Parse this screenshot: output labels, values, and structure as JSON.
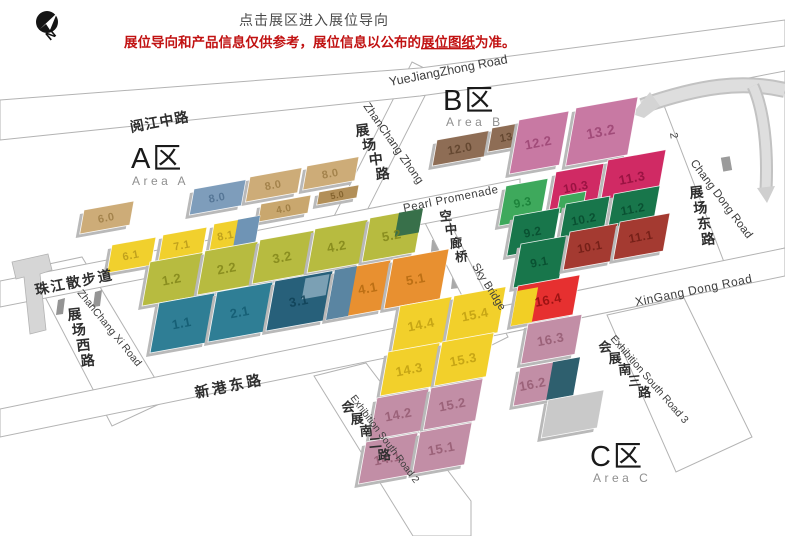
{
  "notice": {
    "click_hint": "点击展区进入展位导向",
    "disclaimer_prefix": "展位导向和产品信息仅供参考，展位信息以公布的",
    "disclaimer_link": "展位图纸",
    "disclaimer_suffix": "为准。",
    "accent_color": "#c11212"
  },
  "compass": {
    "label": "N"
  },
  "areas": [
    {
      "title": "A区",
      "subtitle": "Area A"
    },
    {
      "title": "B区",
      "subtitle": "Area B"
    },
    {
      "title": "C区",
      "subtitle": "Area C"
    }
  ],
  "roads": {
    "yuejiang_cn": "阅江中路",
    "yuejiang_en": "YueJiangZhong Road",
    "zhanchang_zhong_cn": "展场中路",
    "zhanchang_zhong_en": "ZhanChang Zhong",
    "pearl_promenade": "Pearl Promenade",
    "sky_bridge_cn": "空中廊桥",
    "sky_bridge_en": "Sky Bridge",
    "zhanchang_dong_cn": "展场东路",
    "chang_dong_en": "Chang Dong Road",
    "xingang_cn": "新港东路",
    "xingang_en": "XinGang Dong Road",
    "zhujiang_walk_cn": "珠江散步道",
    "zhanchang_xi_cn": "展场西路",
    "zhanchang_xi_en": "ZhanChang Xi Road",
    "south2_cn": "会展南二路",
    "south2_en": "Exhibition South Road 2",
    "south3_cn": "会展南三路",
    "south3_en": "Exhibition South Road 3",
    "stray_marker": "2"
  },
  "halls": [
    {
      "label": "6.0",
      "x": 84,
      "y": 210,
      "w": 50,
      "h": 24,
      "c": "#cdac78",
      "t": "#9a7a42",
      "fs": 11
    },
    {
      "label": "8.0",
      "x": 194,
      "y": 189,
      "w": 52,
      "h": 26,
      "c": "#7e9dbb",
      "t": "#4c6d8e",
      "fs": 11
    },
    {
      "label": "8.0",
      "x": 250,
      "y": 177,
      "w": 52,
      "h": 25,
      "c": "#cdac78",
      "t": "#9a7a42",
      "fs": 11
    },
    {
      "label": "8.0",
      "x": 307,
      "y": 166,
      "w": 52,
      "h": 24,
      "c": "#cdac78",
      "t": "#9a7a42",
      "fs": 11
    },
    {
      "label": "4.0",
      "x": 261,
      "y": 204,
      "w": 50,
      "h": 18,
      "c": "#c9a76e",
      "t": "#97763c",
      "fs": 10
    },
    {
      "label": "5.0",
      "x": 319,
      "y": 192,
      "w": 40,
      "h": 13,
      "c": "#b28f58",
      "t": "#7a5a26",
      "fs": 9
    },
    {
      "label": "",
      "x": 204,
      "y": 286,
      "w": 46,
      "h": 7,
      "c": "#c9a76e",
      "flat": true
    },
    {
      "label": "6.1",
      "x": 112,
      "y": 245,
      "w": 44,
      "h": 28,
      "c": "#f1d02d",
      "t": "#b5961a",
      "fs": 11
    },
    {
      "label": "7.1",
      "x": 163,
      "y": 235,
      "w": 44,
      "h": 28,
      "c": "#f1d02d",
      "t": "#b5961a",
      "fs": 11
    },
    {
      "label": "8.1",
      "x": 214,
      "y": 224,
      "w": 46,
      "h": 28,
      "c": "#f1d02d",
      "t": "#b5961a",
      "fs": 11,
      "lx": 0.32,
      "parts": [
        {
          "x": 24,
          "y": 0,
          "w": 22,
          "h": 28,
          "c": "#6f94b5"
        }
      ]
    },
    {
      "label": "1.2",
      "x": 150,
      "y": 262,
      "w": 53,
      "h": 44,
      "c": "#b7bb40",
      "t": "#7f8318",
      "fs": 13
    },
    {
      "label": "2.2",
      "x": 205,
      "y": 251,
      "w": 53,
      "h": 44,
      "c": "#b7bb40",
      "t": "#7f8318",
      "fs": 13
    },
    {
      "label": "3.2",
      "x": 260,
      "y": 240,
      "w": 54,
      "h": 44,
      "c": "#b7bb40",
      "t": "#7f8318",
      "fs": 13
    },
    {
      "label": "4.2",
      "x": 315,
      "y": 229,
      "w": 53,
      "h": 44,
      "c": "#b7bb40",
      "t": "#7f8318",
      "fs": 13
    },
    {
      "label": "5.2",
      "x": 370,
      "y": 218,
      "w": 53,
      "h": 44,
      "c": "#b7bb40",
      "t": "#7f8318",
      "fs": 13,
      "parts": [
        {
          "x": 29,
          "y": 0,
          "w": 24,
          "h": 24,
          "c": "#38704a"
        }
      ]
    },
    {
      "label": "1.1",
      "x": 159,
      "y": 303,
      "w": 56,
      "h": 50,
      "c": "#2f7e95",
      "t": "#11596f",
      "fs": 13
    },
    {
      "label": "2.1",
      "x": 217,
      "y": 292,
      "w": 56,
      "h": 50,
      "c": "#2f7e95",
      "t": "#11596f",
      "fs": 13
    },
    {
      "label": "3.1",
      "x": 275,
      "y": 281,
      "w": 58,
      "h": 50,
      "c": "#27607a",
      "t": "#0d3f54",
      "fs": 13,
      "parts": [
        {
          "x": 31,
          "y": 3,
          "w": 24,
          "h": 21,
          "c": "#7ba0b4"
        }
      ]
    },
    {
      "label": "4.1",
      "x": 335,
      "y": 270,
      "w": 56,
      "h": 50,
      "c": "#e89030",
      "t": "#b2680e",
      "fs": 13,
      "lx": 0.68,
      "parts": [
        {
          "x": 0,
          "y": 0,
          "w": 22,
          "h": 50,
          "c": "#5a85a2"
        }
      ]
    },
    {
      "label": "5.1",
      "x": 393,
      "y": 259,
      "w": 56,
      "h": 50,
      "c": "#e89030",
      "t": "#b2680e",
      "fs": 13
    },
    {
      "label": "12.0",
      "x": 437,
      "y": 140,
      "w": 52,
      "h": 26,
      "c": "#8e6d55",
      "t": "#5b3f29",
      "fs": 12
    },
    {
      "label": "13.0",
      "x": 492,
      "y": 128,
      "w": 44,
      "h": 24,
      "c": "#8e6d55",
      "t": "#5b3f29",
      "fs": 11
    },
    {
      "label": "12.2",
      "x": 519,
      "y": 120,
      "w": 50,
      "h": 54,
      "c": "#c879a3",
      "t": "#98406f",
      "fs": 13
    },
    {
      "label": "13.2",
      "x": 576,
      "y": 108,
      "w": 62,
      "h": 58,
      "c": "#c879a3",
      "t": "#98406f",
      "fs": 14
    },
    {
      "label": "10.3",
      "x": 556,
      "y": 172,
      "w": 48,
      "h": 38,
      "c": "#d02a64",
      "t": "#8d0e3a",
      "fs": 12
    },
    {
      "label": "9.3",
      "x": 506,
      "y": 186,
      "w": 42,
      "h": 40,
      "c": "#3ea95c",
      "t": "#157a33",
      "fs": 12
    },
    {
      "label": "",
      "x": 560,
      "y": 196,
      "w": 26,
      "h": 18,
      "c": "#3ea95c",
      "flat": true
    },
    {
      "label": "11.3",
      "x": 608,
      "y": 160,
      "w": 58,
      "h": 46,
      "c": "#d02a64",
      "t": "#8d0e3a",
      "fs": 13
    },
    {
      "label": "9.2",
      "x": 514,
      "y": 216,
      "w": 46,
      "h": 40,
      "c": "#18764b",
      "t": "#06492c",
      "fs": 12
    },
    {
      "label": "10.2",
      "x": 566,
      "y": 204,
      "w": 44,
      "h": 38,
      "c": "#18764b",
      "t": "#06492c",
      "fs": 12
    },
    {
      "label": "11.2",
      "x": 614,
      "y": 194,
      "w": 46,
      "h": 38,
      "c": "#18764b",
      "t": "#06492c",
      "fs": 12
    },
    {
      "label": "9.1",
      "x": 521,
      "y": 244,
      "w": 46,
      "h": 44,
      "c": "#18764b",
      "t": "#06492c",
      "fs": 12
    },
    {
      "label": "10.1",
      "x": 570,
      "y": 232,
      "w": 48,
      "h": 38,
      "c": "#a43a31",
      "t": "#6b1a12",
      "fs": 12
    },
    {
      "label": "11.1",
      "x": 620,
      "y": 222,
      "w": 50,
      "h": 38,
      "c": "#a43a31",
      "t": "#6b1a12",
      "fs": 12
    },
    {
      "label": "16.4",
      "x": 518,
      "y": 286,
      "w": 62,
      "h": 40,
      "c": "#e63030",
      "t": "#8d0d0d",
      "fs": 13,
      "lx": 0.56,
      "parts": [
        {
          "x": 0,
          "y": 5,
          "w": 21,
          "h": 35,
          "c": "#f2cf25"
        }
      ]
    },
    {
      "label": "14.4",
      "x": 400,
      "y": 306,
      "w": 52,
      "h": 46,
      "c": "#f2d02b",
      "t": "#bd9c10",
      "fs": 13
    },
    {
      "label": "15.4",
      "x": 454,
      "y": 296,
      "w": 52,
      "h": 46,
      "c": "#f2d02b",
      "t": "#bd9c10",
      "fs": 13
    },
    {
      "label": "14.3",
      "x": 388,
      "y": 352,
      "w": 52,
      "h": 44,
      "c": "#f2d02b",
      "t": "#bd9c10",
      "fs": 13
    },
    {
      "label": "15.3",
      "x": 442,
      "y": 342,
      "w": 52,
      "h": 44,
      "c": "#f2d02b",
      "t": "#bd9c10",
      "fs": 13
    },
    {
      "label": "14.2",
      "x": 377,
      "y": 398,
      "w": 52,
      "h": 42,
      "c": "#c28ea6",
      "t": "#92586f",
      "fs": 13
    },
    {
      "label": "15.2",
      "x": 431,
      "y": 388,
      "w": 52,
      "h": 42,
      "c": "#c28ea6",
      "t": "#92586f",
      "fs": 13
    },
    {
      "label": "14.1",
      "x": 366,
      "y": 442,
      "w": 52,
      "h": 42,
      "c": "#c28ea6",
      "t": "#92586f",
      "fs": 13
    },
    {
      "label": "15.1",
      "x": 420,
      "y": 432,
      "w": 52,
      "h": 42,
      "c": "#c28ea6",
      "t": "#92586f",
      "fs": 13
    },
    {
      "label": "16.3",
      "x": 528,
      "y": 324,
      "w": 54,
      "h": 40,
      "c": "#c28ea6",
      "t": "#92586f",
      "fs": 13
    },
    {
      "label": "16.2",
      "x": 520,
      "y": 368,
      "w": 60,
      "h": 38,
      "c": "#c28ea6",
      "t": "#92586f",
      "fs": 13,
      "lx": 0.28,
      "parts": [
        {
          "x": 33,
          "y": 0,
          "w": 27,
          "h": 38,
          "c": "#2e5f6e"
        }
      ]
    },
    {
      "label": "",
      "x": 548,
      "y": 400,
      "w": 56,
      "h": 38,
      "c": "#c9c9c9"
    }
  ]
}
